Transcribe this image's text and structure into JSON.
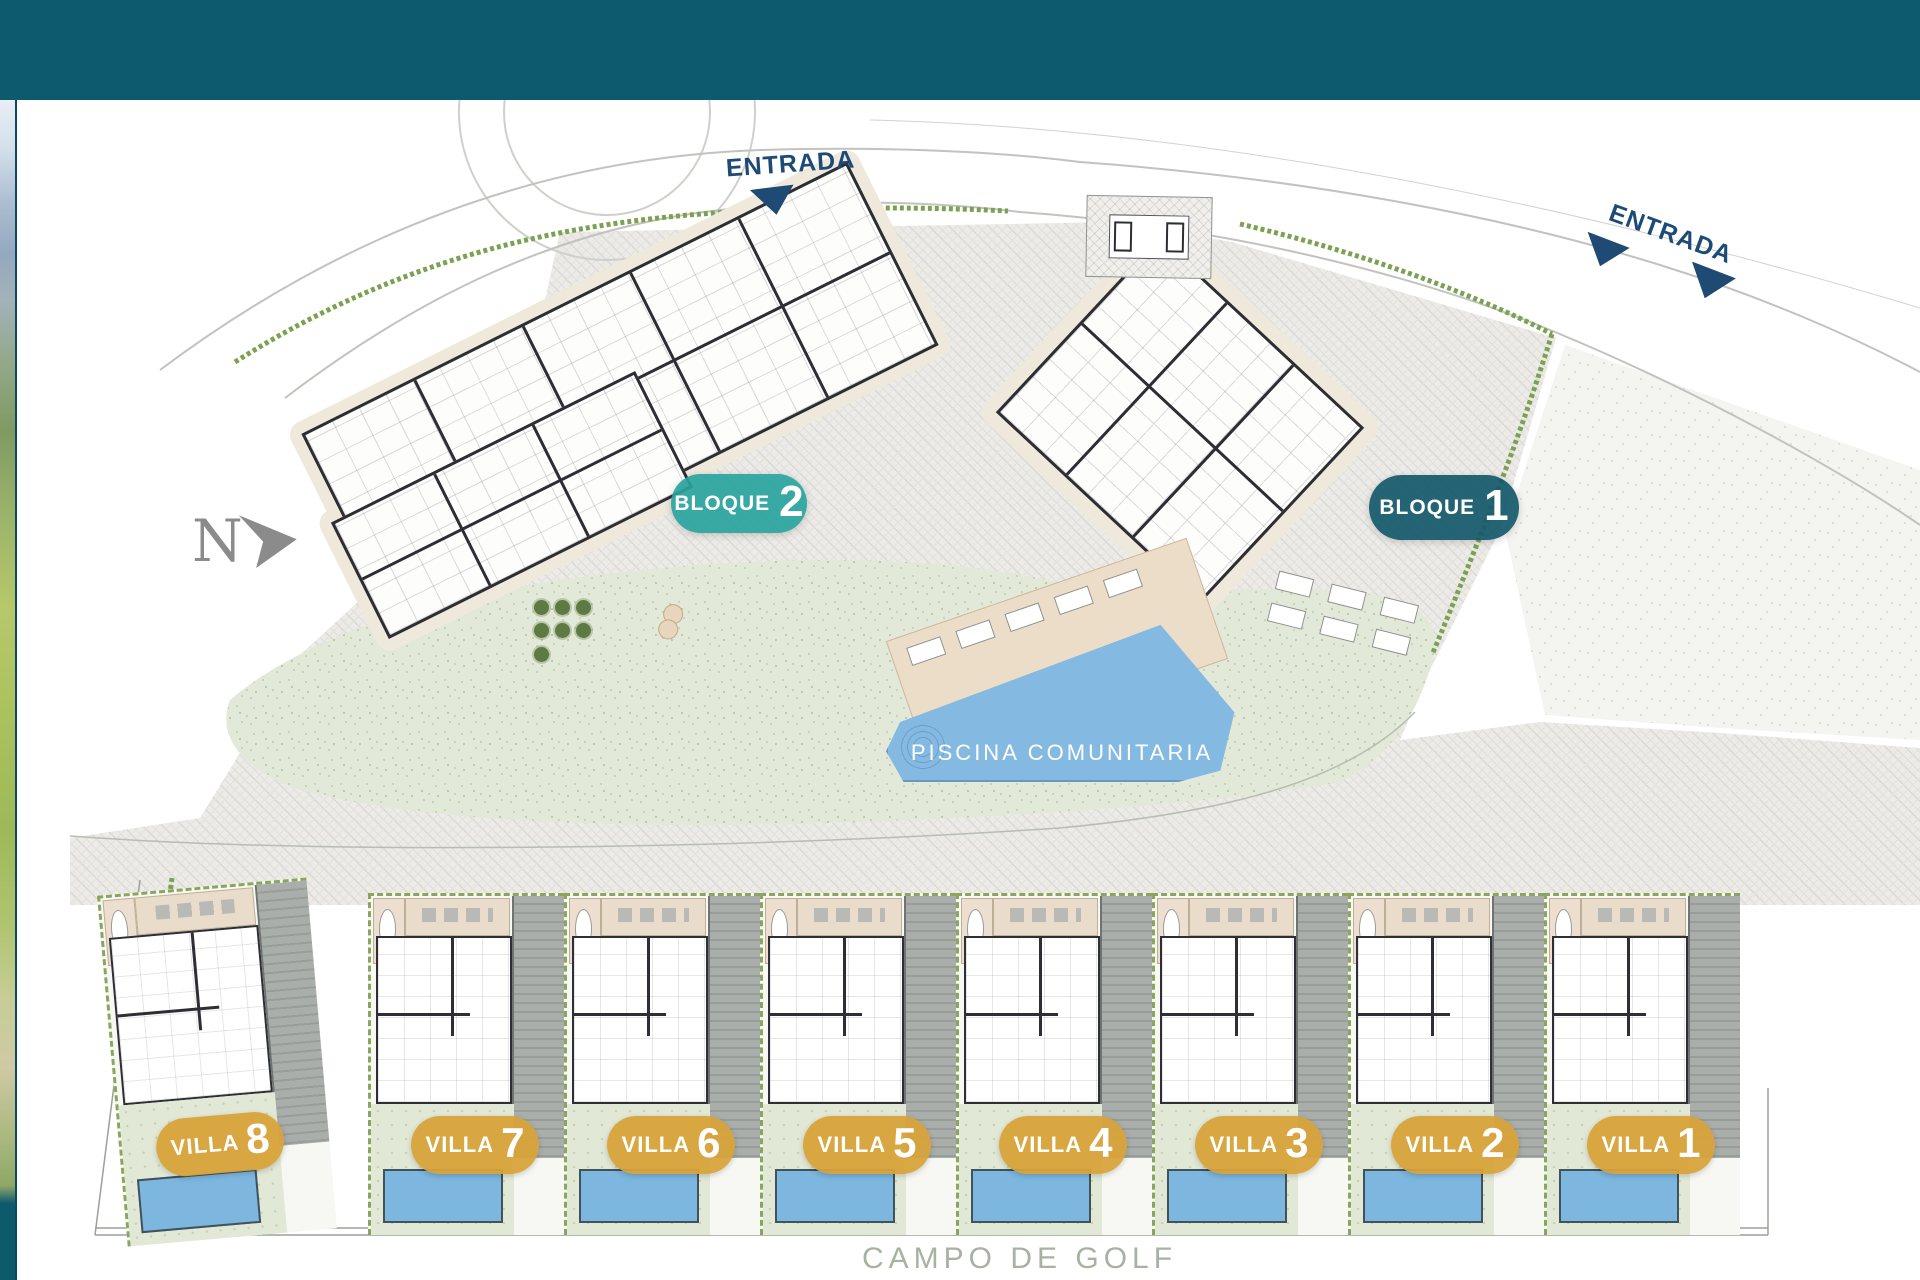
{
  "colors": {
    "header_teal": "#0c5a6e",
    "bloque2_pill": "#29a39e",
    "bloque1_pill": "#15596b",
    "villa_gold": "#d8a337",
    "entrance_navy": "#1d4b76",
    "pool_blue": "#84bae1",
    "hedge_green": "#7da152"
  },
  "plan": {
    "north": {
      "label": "N"
    },
    "entrances": [
      {
        "label": "ENTRADA"
      },
      {
        "label": "ENTRADA"
      }
    ],
    "blocks": [
      {
        "label": "BLOQUE",
        "number": "2"
      },
      {
        "label": "BLOQUE",
        "number": "1"
      }
    ],
    "pool": {
      "label": "PISCINA COMUNITARIA"
    },
    "villas": [
      {
        "label": "VILLA",
        "number": "8"
      },
      {
        "label": "VILLA",
        "number": "7"
      },
      {
        "label": "VILLA",
        "number": "6"
      },
      {
        "label": "VILLA",
        "number": "5"
      },
      {
        "label": "VILLA",
        "number": "4"
      },
      {
        "label": "VILLA",
        "number": "3"
      },
      {
        "label": "VILLA",
        "number": "2"
      },
      {
        "label": "VILLA",
        "number": "1"
      }
    ],
    "footer": {
      "label": "CAMPO DE GOLF"
    }
  }
}
